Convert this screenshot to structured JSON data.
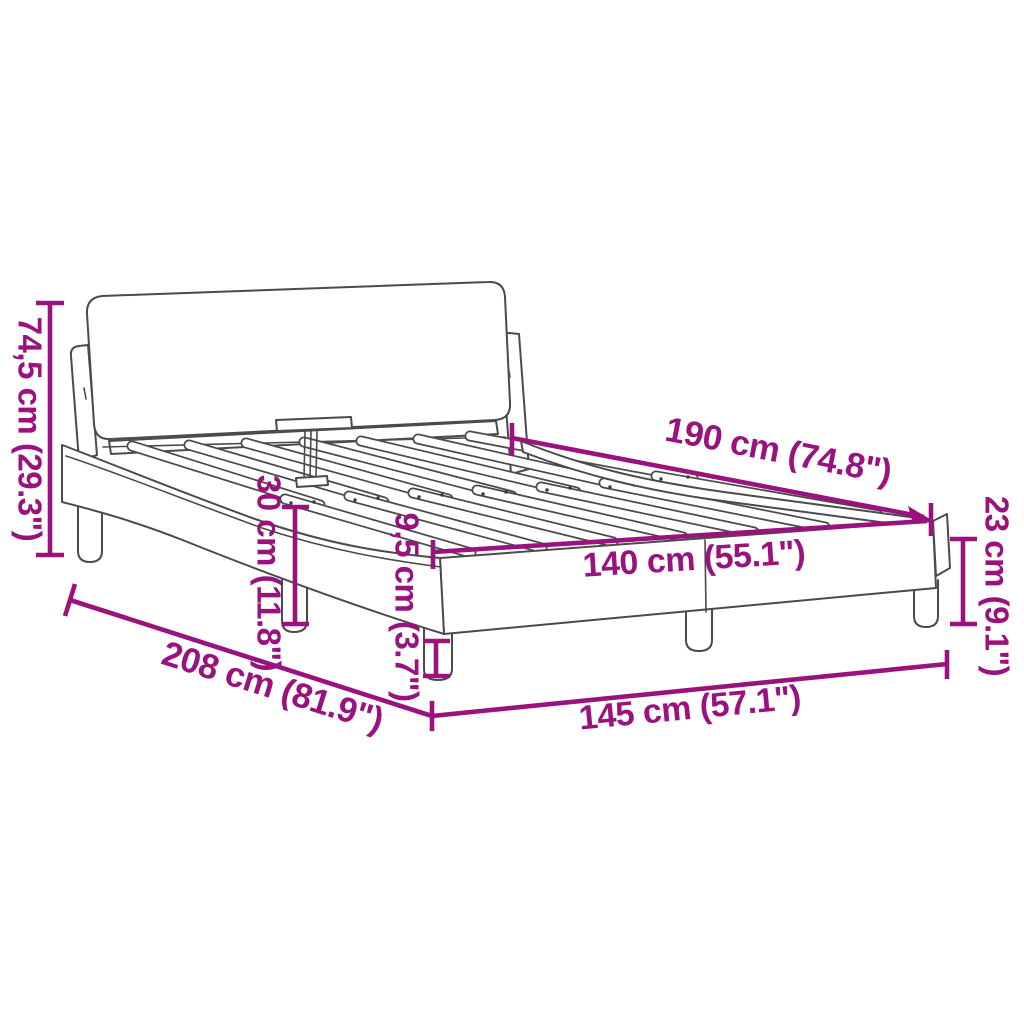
{
  "figure": {
    "type": "product-dimension-diagram",
    "subject": "bed-frame-with-curved-side-rails-and-headboard",
    "colors": {
      "dimension_accent": "#99127E",
      "line_art": "#4B4B4B",
      "background": "#FFFFFF"
    }
  },
  "dimensions": {
    "headboard_height": {
      "label": "74,5 cm (29.3\")"
    },
    "headboard_to_slats": {
      "label": "30 cm (11.8\")"
    },
    "slat_length": {
      "label": "190 cm (74.8\")"
    },
    "slat_width": {
      "label": "140 cm (55.1\")"
    },
    "leg_height": {
      "label": "9,5 cm (3.7\")"
    },
    "side_height": {
      "label": "23 cm (9.1\")"
    },
    "total_length": {
      "label": "208 cm (81.9\")"
    },
    "total_width": {
      "label": "145 cm (57.1\")"
    }
  }
}
